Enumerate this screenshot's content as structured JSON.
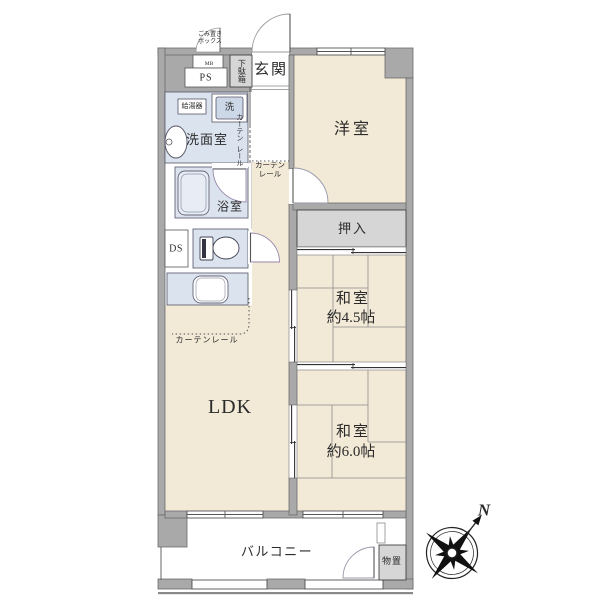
{
  "floorplan": {
    "rooms": {
      "genkan": "玄関",
      "western_room": "洋室",
      "closet": "押入",
      "japanese_room_45": {
        "name": "和室",
        "size": "約4.5帖"
      },
      "japanese_room_60": {
        "name": "和室",
        "size": "約6.0帖"
      },
      "ldk": "LDK",
      "washroom": "洗面室",
      "bathroom": "浴室",
      "balcony": "バルコニー",
      "storage": "物置"
    },
    "labels": {
      "shoe_cabinet": "下駄箱",
      "meter_box": "MB",
      "pipe_space": "PS",
      "duct_space": "DS",
      "water_heater": "給湯器",
      "washer": "洗",
      "garbage_box_line1": "ごみ置き",
      "garbage_box_line2": "ボックス",
      "curtain_rail": "カーテンレール",
      "curtain_rail_l1": "カーテン",
      "curtain_rail_l2": "レール"
    },
    "compass": {
      "north": "N"
    },
    "colors": {
      "room_floor": "#f2e9d6",
      "wet_floor": "#dbe3ef",
      "wall": "#a9a9a9",
      "closet_fill": "#d6d6d6",
      "outline": "#555555"
    }
  }
}
